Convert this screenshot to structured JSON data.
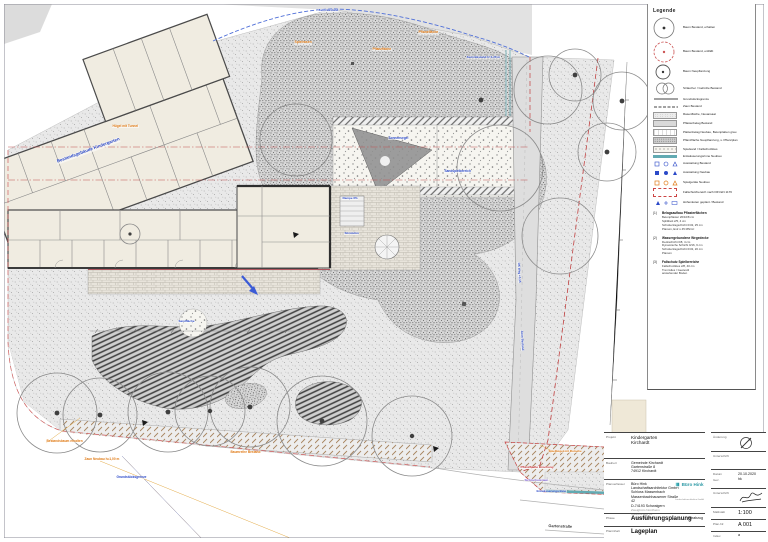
{
  "sheet": {
    "name": "Lageplan Kindergarten Kirchardt"
  },
  "legend": {
    "title": "Legende",
    "items": [
      {
        "type": "tree-exist",
        "label": "Baum Bestand, erhalten"
      },
      {
        "type": "tree-remove",
        "label": "Baum Bestand, entfällt"
      },
      {
        "type": "tree-new",
        "label": "Baum Neupflanzung"
      },
      {
        "type": "shrub",
        "label": "Sträucher / Gehölze Bestand"
      },
      {
        "type": "line-solid",
        "label": "Grundstücksgrenze"
      },
      {
        "type": "line-dash",
        "label": "Zaun Bestand"
      },
      {
        "type": "sw-stipple-light",
        "label": "Rasenfläche, Neuansaat"
      },
      {
        "type": "sw-gray",
        "label": "Pflasterbelag Bestand"
      },
      {
        "type": "sw-outline",
        "label": "Plattenbelag Neubau, Betonplatten grau"
      },
      {
        "type": "sw-stipple-dark",
        "label": "Pflanzfläche Neupflanzung, s. Pflanzplan"
      },
      {
        "type": "sw-coarse",
        "label": "Spielsand / Fallschutzkies"
      },
      {
        "type": "bar-teal",
        "label": "Entwässerungsrinne Neubau"
      },
      {
        "type": "sym-blue",
        "label": "Ausstattung Bestand"
      },
      {
        "type": "sym-blue2",
        "label": "Ausstattung Neubau"
      },
      {
        "type": "sym-orange",
        "label": "Spielgeräte Neubau"
      },
      {
        "type": "rect-red",
        "label": "Fallschutzbereich nach DIN EN 1176"
      },
      {
        "type": "sym-h",
        "label": "Höhenkoten geplant / Bestand"
      }
    ],
    "notes": [
      {
        "num": "(1)",
        "title": "Belagsaufbau Pflasterflächen",
        "lines": [
          "Betonpflaster 20/10/8 cm",
          "Splittbett 2/5, 4 cm",
          "Schottertragschicht 0/32, 25 cm",
          "Planum, Ev2 ≥ 45 MN/m²"
        ]
      },
      {
        "num": "(2)",
        "title": "Wassergebundene Wegedecke",
        "lines": [
          "Deckschicht 0/8, 4 cm",
          "Dynamische Schicht 0/16, 6 cm",
          "Schottertragschicht 0/32, 20 cm",
          "Planum"
        ]
      },
      {
        "num": "(3)",
        "title": "Fallschutz Spielbereiche",
        "lines": [
          "Fallschutzkies 2/8, 40 cm",
          "Trennvlies / Geotextil",
          "anstehender Boden"
        ]
      }
    ]
  },
  "plan": {
    "annotations": [
      {
        "t": "Bestandsgebäude Kindergarten",
        "c": "blue",
        "x": 56,
        "y": 160,
        "r": -20,
        "s": 4.4
      },
      {
        "t": "Hügel mit Tunnel",
        "c": "orange",
        "x": 112,
        "y": 125,
        "s": 3.2
      },
      {
        "t": "Spielrasen",
        "c": "orange",
        "x": 294,
        "y": 41,
        "s": 3.4
      },
      {
        "t": "Pflanzfläche",
        "c": "orange",
        "x": 418,
        "y": 31,
        "s": 3.4
      },
      {
        "t": "Pflanzfläche",
        "c": "orange",
        "x": 372,
        "y": 48,
        "s": 3.2
      },
      {
        "t": "Zaun Bestand",
        "c": "blue",
        "x": 318,
        "y": 9,
        "s": 3
      },
      {
        "t": "Zaun Bestand h=1,20 m",
        "c": "blue",
        "x": 466,
        "y": 56,
        "s": 3
      },
      {
        "t": "Sonnensegel",
        "c": "blue",
        "x": 388,
        "y": 137,
        "s": 3.2
      },
      {
        "t": "Sandspielbereich",
        "c": "blue",
        "x": 444,
        "y": 170,
        "s": 3.2
      },
      {
        "t": "Rampe 6%",
        "c": "blue",
        "x": 342,
        "y": 197,
        "s": 3
      },
      {
        "t": "Sitzstufen",
        "c": "blue",
        "x": 344,
        "y": 232,
        "s": 3
      },
      {
        "t": "OK Weg +0,15",
        "c": "blue",
        "x": 520,
        "y": 262,
        "r": 87,
        "s": 3
      },
      {
        "t": "Zaun Bestand",
        "c": "blue",
        "x": 523,
        "y": 330,
        "r": 87,
        "s": 3
      },
      {
        "t": "Sandfläche",
        "c": "blue",
        "x": 178,
        "y": 320,
        "s": 3
      },
      {
        "t": "Bestandsbaum erhalten",
        "c": "orange",
        "x": 46,
        "y": 440,
        "s": 3.2
      },
      {
        "t": "Zaun Neubau h=1,00 m",
        "c": "orange",
        "x": 84,
        "y": 458,
        "s": 3.2
      },
      {
        "t": "Grundstücksgrenze",
        "c": "blue",
        "x": 116,
        "y": 476,
        "s": 3.2
      },
      {
        "t": "Baumreihe Bestand",
        "c": "orange",
        "x": 230,
        "y": 451,
        "s": 3.2
      },
      {
        "t": "Spielhügel mit Rutsche",
        "c": "orange",
        "x": 548,
        "y": 450,
        "s": 3
      },
      {
        "t": "Pflanzfläche Böschung",
        "c": "red",
        "x": 520,
        "y": 466,
        "s": 3
      },
      {
        "t": "Sichtschutzzaun",
        "c": "purple",
        "x": 524,
        "y": 479,
        "s": 3
      },
      {
        "t": "Entwässerungsrinne",
        "c": "blue",
        "x": 536,
        "y": 490,
        "s": 3
      },
      {
        "t": "Gartenstraße",
        "c": "black",
        "x": 548,
        "y": 524,
        "r": 2,
        "s": 3.8
      }
    ]
  },
  "title_block": {
    "project_label": "Projekt",
    "project_line1": "Kindergarten",
    "project_line2": "Kirchardt",
    "client_label": "Bauherr",
    "client_lines": "Gemeinde Kirchardt\nGartenstraße 8\n74912 Kirchardt",
    "planner_label": "Planverfasser",
    "planner_lines": "Büro Hink Landschaftsarchitektur GmbH\nSchloss Massenbach\nMassenbachhausener Straße 42\nD-74193 Schwaigern",
    "planner_sub": "Zweigbüro Nordheim\nHauptstraße 31\nD-74226 Nordheim",
    "logo_name": "Büro Hink",
    "logo_sub": "Landschaftsarchitektur GmbH",
    "phase_label": "Phase",
    "phase": "Ausführungsplanung",
    "planstand_label": "Planstand",
    "planstand": "Vorabzug",
    "content_label": "Planinhalt",
    "content": "Lageplan",
    "revision_label": "Änderung",
    "signature_label": "Unterschrift",
    "date_label": "Datum",
    "date": "20.10.2020",
    "drawn_label": "Gez.",
    "drawn": "hk",
    "signature2_label": "Unterschrift",
    "scale_label": "Maßstab",
    "scale": "1:100",
    "plan_no_label": "Plan-Nr.",
    "plan_no": "A 001",
    "index_label": "Index",
    "index": "a"
  }
}
